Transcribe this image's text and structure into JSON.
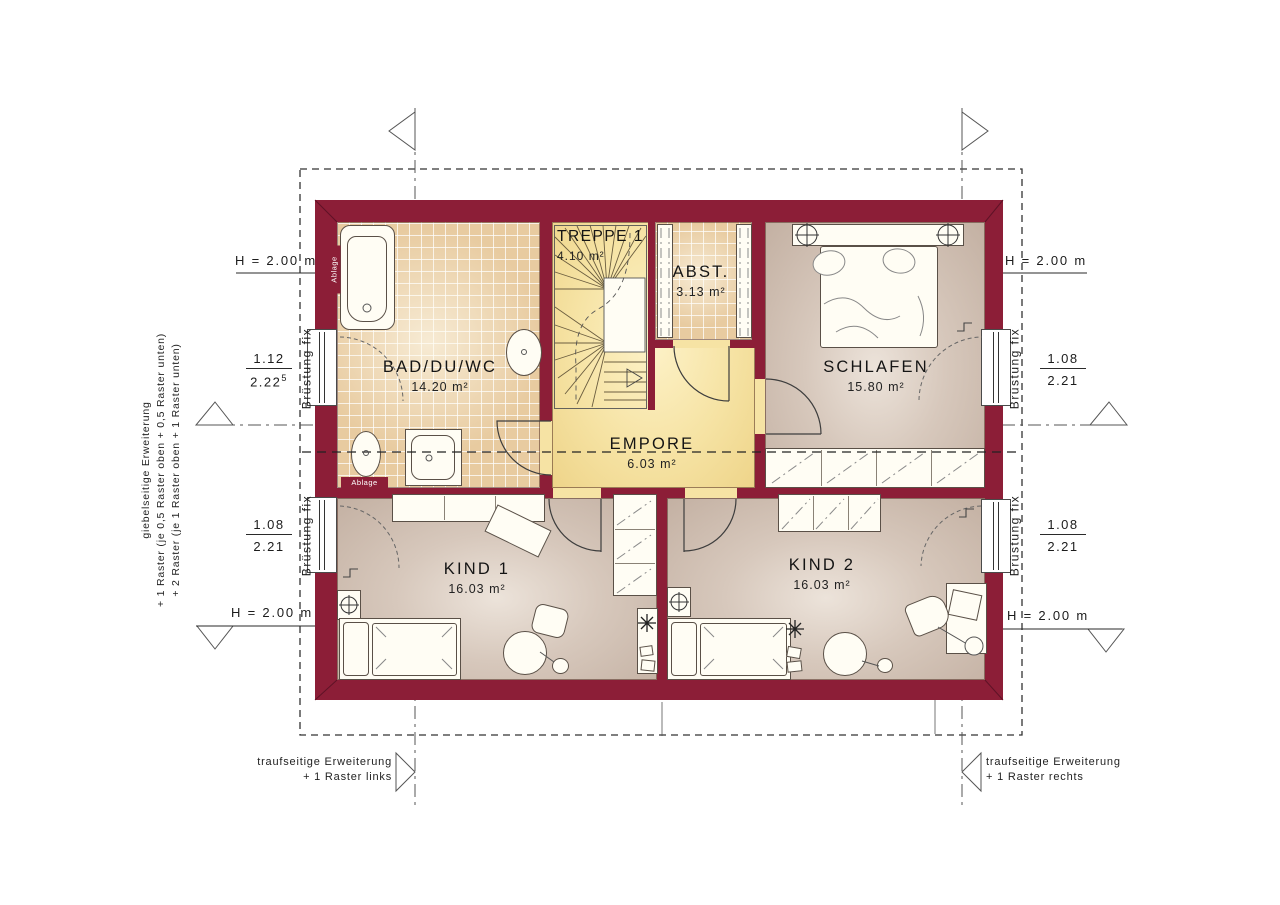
{
  "plan": {
    "rooms": [
      {
        "name": "BAD/DU/WC",
        "area": "14.20 m²"
      },
      {
        "name": "TREPPE 1",
        "area": "4.10 m²"
      },
      {
        "name": "ABST.",
        "area": "3.13 m²"
      },
      {
        "name": "SCHLAFEN",
        "area": "15.80 m²"
      },
      {
        "name": "EMPORE",
        "area": "6.03 m²"
      },
      {
        "name": "KIND 1",
        "area": "16.03 m²"
      },
      {
        "name": "KIND 2",
        "area": "16.03 m²"
      }
    ],
    "shelf_label_vertical": "Ablage",
    "shelf_label_horizontal": "Ablage"
  },
  "dimensions": {
    "height_label": "H = 2.00 m",
    "bruestung_label": "Brüstung fix",
    "left_top": {
      "num": "1.12",
      "den": "2.22",
      "sup": "5"
    },
    "left_bottom": {
      "num": "1.08",
      "den": "2.21"
    },
    "right_top": {
      "num": "1.08",
      "den": "2.21"
    },
    "right_bottom": {
      "num": "1.08",
      "den": "2.21"
    }
  },
  "annotations": {
    "gable_note": {
      "line1": "giebelseitige Erweiterung",
      "line2": "+ 1 Raster (je 0,5 Raster oben + 0,5 Raster unten)",
      "line3": "+ 2 Raster (je 1 Raster oben + 1 Raster unten)"
    },
    "eaves_left": {
      "line1": "traufseitige Erweiterung",
      "line2": "+ 1 Raster links"
    },
    "eaves_right": {
      "line1": "traufseitige Erweiterung",
      "line2": "+ 1 Raster rechts"
    }
  },
  "colors": {
    "wall": "#8c1e37",
    "tile": "#e8cba0",
    "landing": "#f6e3a4",
    "floor": "#ccbaad"
  }
}
